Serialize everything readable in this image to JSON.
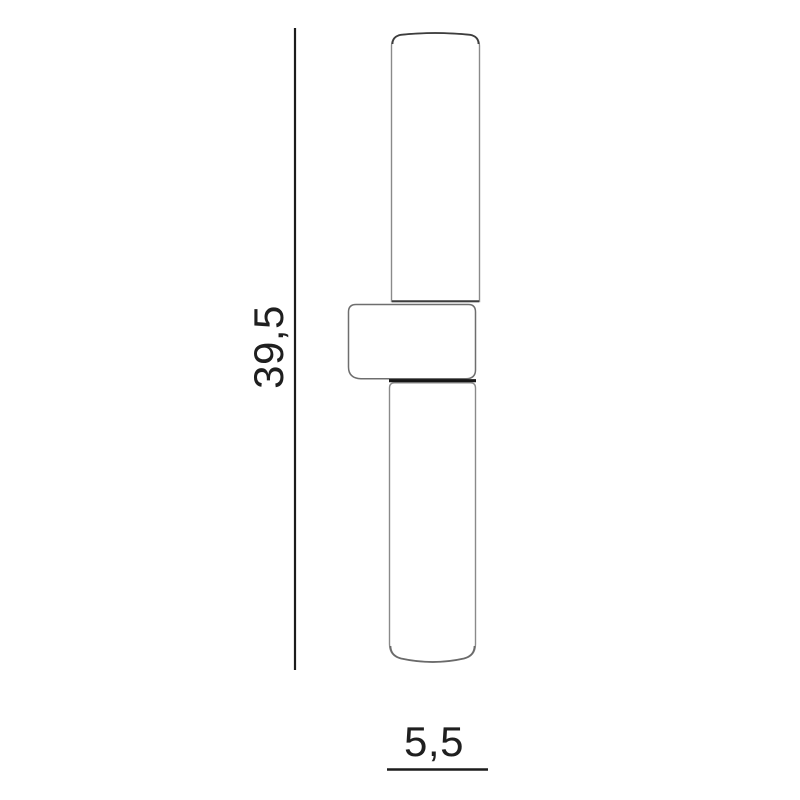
{
  "diagram": {
    "height_dimension": {
      "label": "39,5"
    },
    "width_dimension": {
      "label": "5,5"
    },
    "colors": {
      "background": "#ffffff",
      "dimension_line": "#1c1c1c",
      "label_text": "#1f1f1f",
      "tube_outline": "#8a8a8a",
      "tube_edge_dark": "#3d3d3d",
      "bracket_outline": "#6e6e6e",
      "junction_line": "#161616",
      "shape_fill": "#ffffff"
    }
  }
}
